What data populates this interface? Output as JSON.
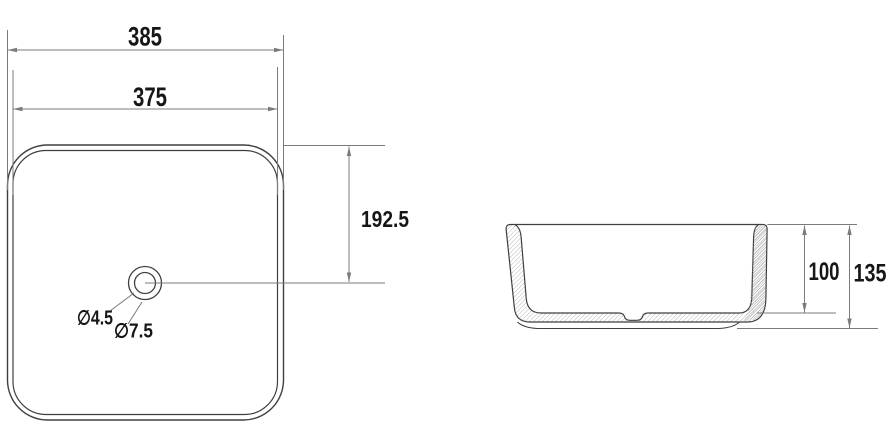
{
  "drawing": {
    "kind": "technical-dimension-drawing",
    "views": {
      "top_view": "plan view of square basin with drain hole",
      "side_view": "sectional side view of basin with hatched walls"
    }
  },
  "dimensions": {
    "top_view": {
      "overall_width": "385",
      "inner_width": "375",
      "center_offset": "192.5",
      "drain_small_diameter": "∅4.5",
      "drain_large_diameter": "∅7.5"
    },
    "side_view": {
      "inner_depth": "100",
      "overall_height": "135"
    }
  },
  "colors": {
    "background": "#ffffff",
    "outline": "#3f3f3f",
    "dimension_line": "#7b7b7b",
    "text": "#161616",
    "hatch": "#a6a6a6"
  }
}
